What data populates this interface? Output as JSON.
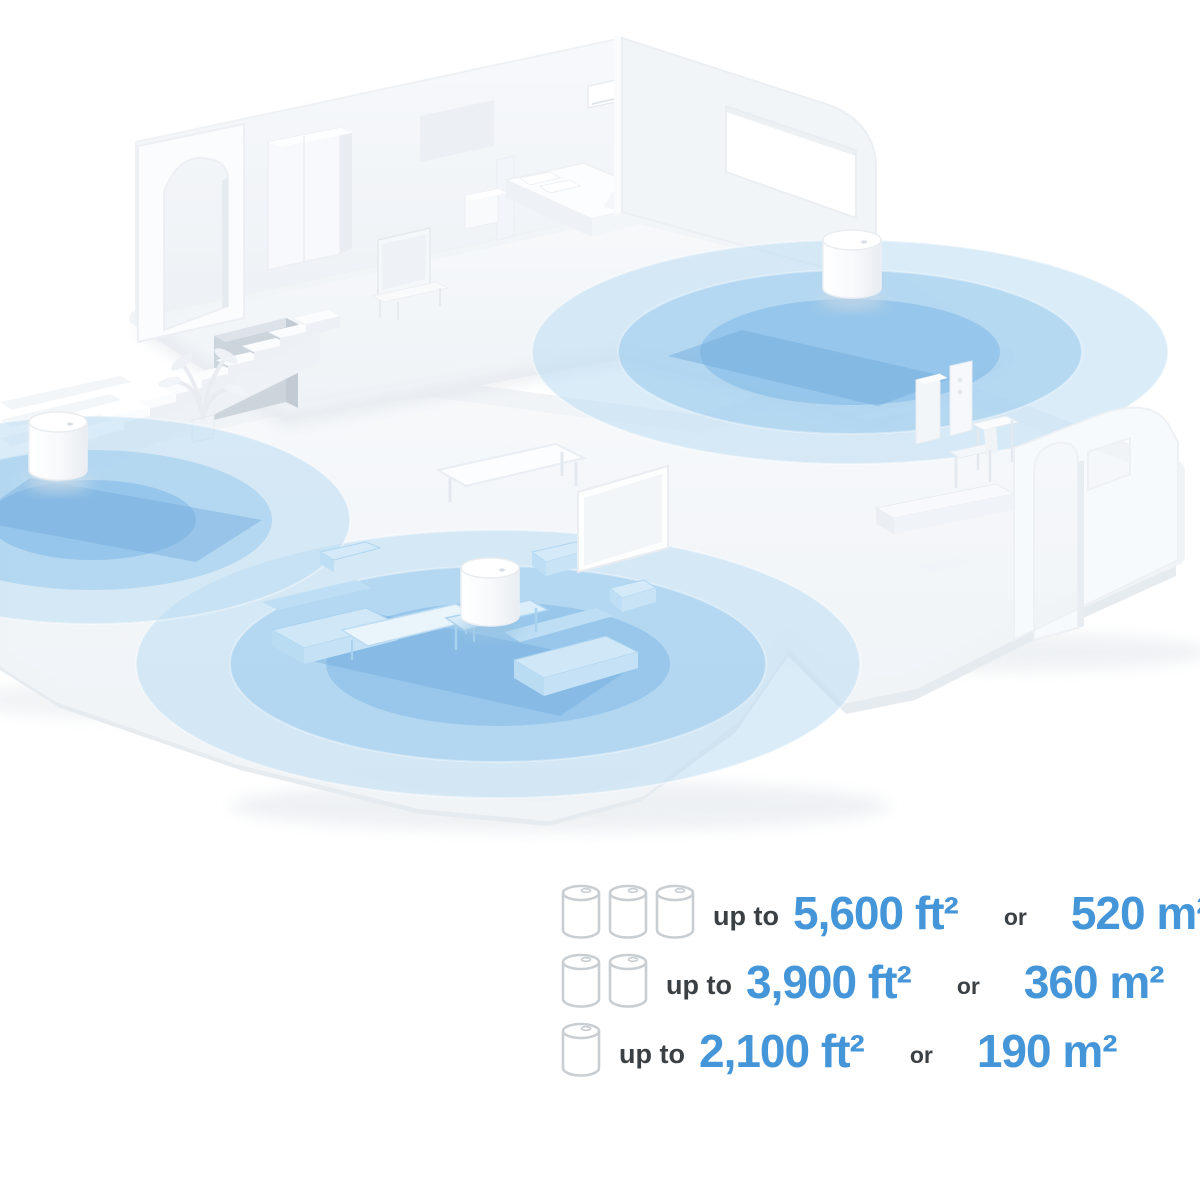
{
  "legend": {
    "rows": [
      {
        "units": 3,
        "prefix": "up to",
        "imperial": "5,600 ft²",
        "conjunction": "or",
        "metric": "520 m²"
      },
      {
        "units": 2,
        "prefix": "up to",
        "imperial": "3,900 ft²",
        "conjunction": "or",
        "metric": "360 m²"
      },
      {
        "units": 1,
        "prefix": "up to",
        "imperial": "2,100 ft²",
        "conjunction": "or",
        "metric": "190 m²"
      }
    ],
    "colors": {
      "value_text": "#4596d8",
      "label_text": "#3b4044",
      "icon_outline": "#c9ced3",
      "coverage_blue": "#7fb9e6"
    }
  },
  "illustration": {
    "type": "isometric-home-wifi-coverage",
    "mesh_units": [
      "upper-floor-unit",
      "entry-hall-unit",
      "living-room-unit"
    ],
    "coverage_zones": 3
  }
}
